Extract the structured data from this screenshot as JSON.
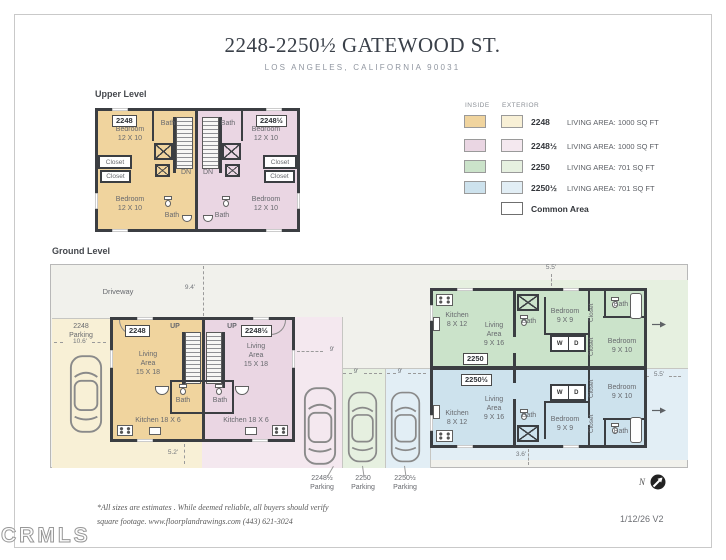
{
  "title": {
    "address": "2248-2250½ GATEWOOD ST.",
    "city": "LOS ANGELES, CALIFORNIA  90031"
  },
  "palette": {
    "inside_2248": "#f0d49e",
    "exterior_2248": "#f8f0d6",
    "inside_2248h": "#ead6e3",
    "exterior_2248h": "#f4e8ef",
    "inside_2250": "#cbe3ca",
    "exterior_2250": "#e6f0e0",
    "inside_2250h": "#cde2ed",
    "exterior_2250h": "#e2eef5",
    "common": "#f1f1ec",
    "wall": "#3b3e42"
  },
  "legend": {
    "inside_header": "INSIDE",
    "exterior_header": "EXTERIOR",
    "rows": [
      {
        "unit": "2248",
        "desc": "LIVING AREA: 1000 SQ FT"
      },
      {
        "unit": "2248½",
        "desc": "LIVING AREA: 1000 SQ FT"
      },
      {
        "unit": "2250",
        "desc": "LIVING AREA:  701 SQ FT"
      },
      {
        "unit": "2250½",
        "desc": "LIVING AREA: 701 SQ FT"
      },
      {
        "unit": "Common Area",
        "desc": ""
      }
    ]
  },
  "upper": {
    "section_label": "Upper Level",
    "badge_left": "2248",
    "badge_right": "2248½",
    "bedroom": "Bedroom\n12 X 10",
    "bath": "Bath",
    "closet": "Closet",
    "dn": "DN"
  },
  "ground": {
    "section_label": "Ground Level",
    "driveway": "Driveway",
    "parking_2248": "2248\nParking",
    "parking_2248h": "2248½\nParking",
    "parking_2250": "2250\nParking",
    "parking_2250h": "2250½\nParking",
    "dims": {
      "drive_width": "9.4'",
      "parking_2248_width": "10.6'",
      "stall_width": "9'",
      "unitA_gap": "5.2'",
      "unitB_top": "5.5'",
      "unitB_right": "5.5'",
      "unitB_bottom": "3.6'"
    },
    "unitA": {
      "badge_left": "2248",
      "badge_right": "2248½",
      "up": "UP",
      "living": "Living\nArea\n15 X 18",
      "bath": "Bath",
      "kitchen": "Kitchen 18 X 6"
    },
    "unitB": {
      "badge_top": "2250",
      "badge_bottom": "2250½",
      "kitchen": "Kitchen\n8 X 12",
      "living": "Living\nArea\n9 X 16",
      "bath": "Bath",
      "bed_9x9": "Bedroom\n9 X 9",
      "bed_9x10": "Bedroom\n9 X 10",
      "closet": "Closet",
      "washer": "W",
      "dryer": "D"
    }
  },
  "footer": {
    "note_line1": "*All sizes are estimates . While deemed reliable, all buyers should verify",
    "note_line2": "square footage.   www.floorplandrawings.com   (443) 621-3024",
    "watermark": "CRMLS",
    "version": "1/12/26  V2",
    "compass": "N"
  }
}
